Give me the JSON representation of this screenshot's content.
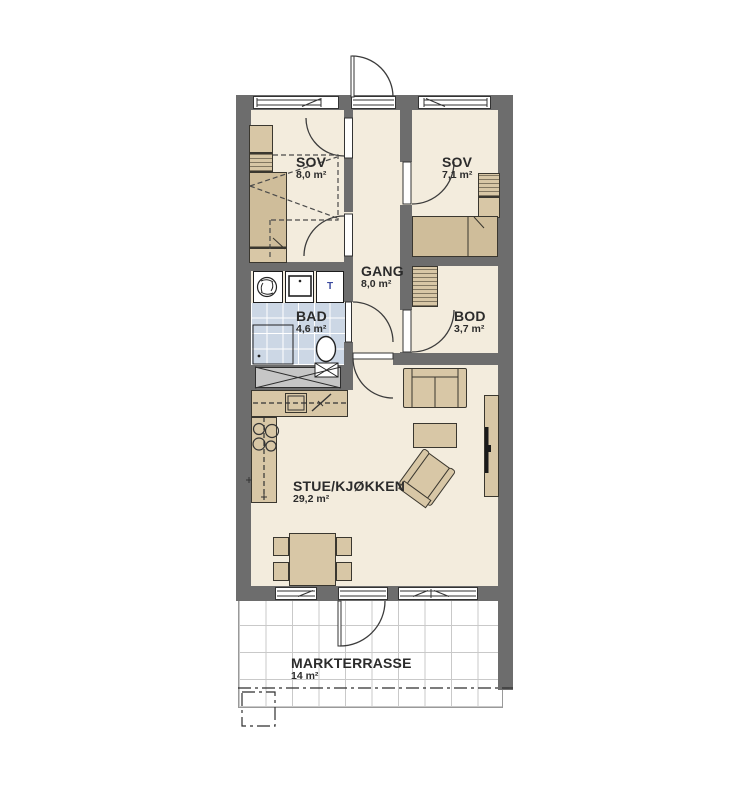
{
  "rooms": [
    {
      "name": "SOV",
      "area": "8,0 m²"
    },
    {
      "name": "SOV",
      "area": "7,1 m²"
    },
    {
      "name": "GANG",
      "area": "8,0 m²"
    },
    {
      "name": "BAD",
      "area": "4,6 m²"
    },
    {
      "name": "BOD",
      "area": "3,7 m²"
    },
    {
      "name": "STUE/KJØKKEN",
      "area": "29,2 m²"
    },
    {
      "name": "MARKTERRASSE",
      "area": "14 m²"
    }
  ],
  "fixtures": {
    "dryer_label": "T",
    "washer_label": "W"
  },
  "colors": {
    "wall": "#6d6d6d",
    "floor": "#f3ecdd",
    "furniture": "#d8c7a6",
    "furniture_dark": "#cfbd9a",
    "outline": "#3a372f",
    "tile": "#ccd7e5",
    "terrace_line": "#c9c9c9"
  }
}
